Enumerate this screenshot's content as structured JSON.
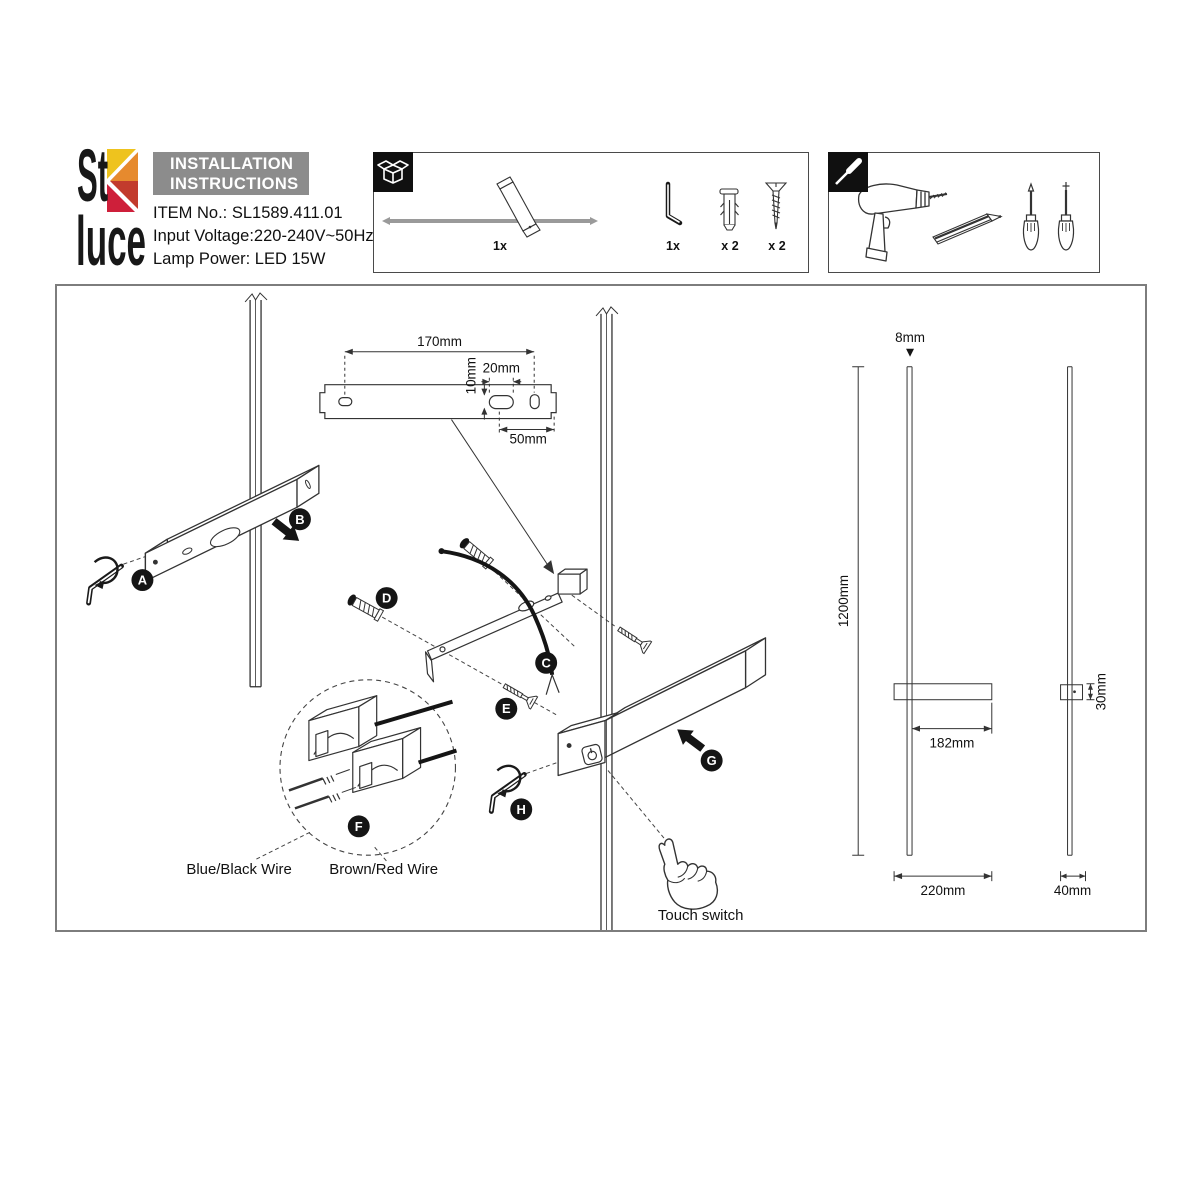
{
  "brand": {
    "logo_top": "St",
    "logo_bottom": "luce"
  },
  "header": {
    "title_line1": "INSTALLATION",
    "title_line2": "INSTRUCTIONS",
    "item_no": "ITEM No.: SL1589.411.01",
    "input_voltage": "Input Voltage:220-240V~50Hz",
    "lamp_power": "Lamp Power: LED 15W"
  },
  "package_contents": {
    "lamp_qty": "1x",
    "hex_key_qty": "1x",
    "anchor_qty": "x 2",
    "screw_qty": "x 2"
  },
  "steps": {
    "a": "A",
    "b": "B",
    "c": "C",
    "d": "D",
    "e": "E",
    "f": "F",
    "g": "G",
    "h": "H"
  },
  "wiring": {
    "blue_black": "Blue/Black Wire",
    "brown_red": "Brown/Red Wire"
  },
  "controls": {
    "touch_switch": "Touch switch"
  },
  "dimensions": {
    "bracket_length": "170mm",
    "slot_height": "10mm",
    "slot_width": "20mm",
    "slot_offset": "50mm",
    "rod_diameter": "8mm",
    "fixture_height": "1200mm",
    "arm_length": "182mm",
    "base_width": "220mm",
    "body_depth": "30mm",
    "side_width": "40mm"
  },
  "colors": {
    "logo_yellow": "#EEC31E",
    "logo_orange": "#E68A2E",
    "logo_red": "#C23B2D",
    "logo_crimson": "#CE1F3A",
    "title_bg": "#8C8C8C",
    "line": "#1A1A1A",
    "frame": "#7D7D7D"
  }
}
